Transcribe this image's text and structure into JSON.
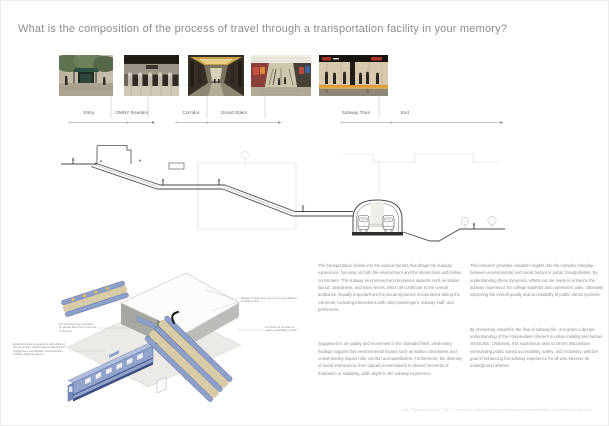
{
  "title": "What is the composition of the process of travel through a transportation facility in your memory?",
  "timeline": {
    "stages": [
      {
        "label": "Entry"
      },
      {
        "label": "OMNY Readers"
      },
      {
        "label": "Corridor"
      },
      {
        "label": "Grand Stairs"
      },
      {
        "label": "Subway Train"
      },
      {
        "label": "Exit"
      }
    ]
  },
  "photos": [
    {
      "id": "entry",
      "description": "Street-level subway entrance with green canopy under trees"
    },
    {
      "id": "omny-readers",
      "description": "Row of fare-gate turnstiles with OMNY tap readers"
    },
    {
      "id": "corridor",
      "description": "Symmetrical subway mezzanine corridor"
    },
    {
      "id": "grand-stairs",
      "description": "Grand stair and escalator hall lined with posters"
    },
    {
      "id": "subway-train",
      "description": "Passengers waiting on the platform beside a subway train"
    }
  ],
  "section_diagram": {
    "description": "Street-to-platform section: entry stair, descending escalators, mezzanine corridor and vaulted platform with two trains"
  },
  "axonometric": {
    "description": "Exploded axonometric of the station: mezzanine slab, escalator banks, platform columns and train",
    "annotations": {
      "skylight": "Skylight to draw open air in to see how efficient escalators flow",
      "circulation": "Get and keep way circulation for people that come in and out of the train",
      "engagement": "Expand/improve engagement with efficiency: info on arrivals, updates about waiting times, engagement and facilitate communication between staff and patrons",
      "accessibility": "Promotion of purpose for easier accessibility to halls"
    }
  },
  "essay": {
    "column_1": [
      "The transportation delves into the various factors that shape the subway experience, focusing on both the environment and the interactions with fellow commuters. The subway environment encompasses aspects such as station layout, cleanliness, and noise levels, which all contribute to the overall ambiance. Equally important are the social dynamics encountered during the commute, including interactions with other passengers, subway staff, and performers.",
      "Suggested in air quality and movement in the Standard Well, preliminary findings suggest that environmental factors such as station cleanliness and crowd density impact rider comfort and satisfaction. Furthermore, the diversity of social interactions, from casual conversations to shared moments of frustration or solidarity, adds depth to the subway experience."
    ],
    "column_2": [
      "This research provides valuable insights into the complex interplay between environmental and social factors in public transportation. By understanding these dynamics, efforts can be made to enhance the subway experience for college students and commuters alike, ultimately improving the overall quality and accessibility of public transit systems.",
      "By immersing oneself in the flow of subway life, one gains a deeper understanding of the complexities inherent in urban mobility and human interaction. Ultimately, this exploration aims to inform discussions surrounding public transit accessibility, safety, and inclusivity, with the goal of enhancing the subway experience for all who traverse its underground arteries."
    ]
  },
  "footnote": "Web. \"Standard Well 42.\" 2012. E-posted, 12 web architecture/urban/parks/movement/feature 5. Accessed 31 Mar 2024.",
  "palette": {
    "accent_blue": "#8ea0c9",
    "accent_navy": "#46598f",
    "accent_beige": "#d9cca9",
    "line_gray": "#8a8a8a"
  }
}
